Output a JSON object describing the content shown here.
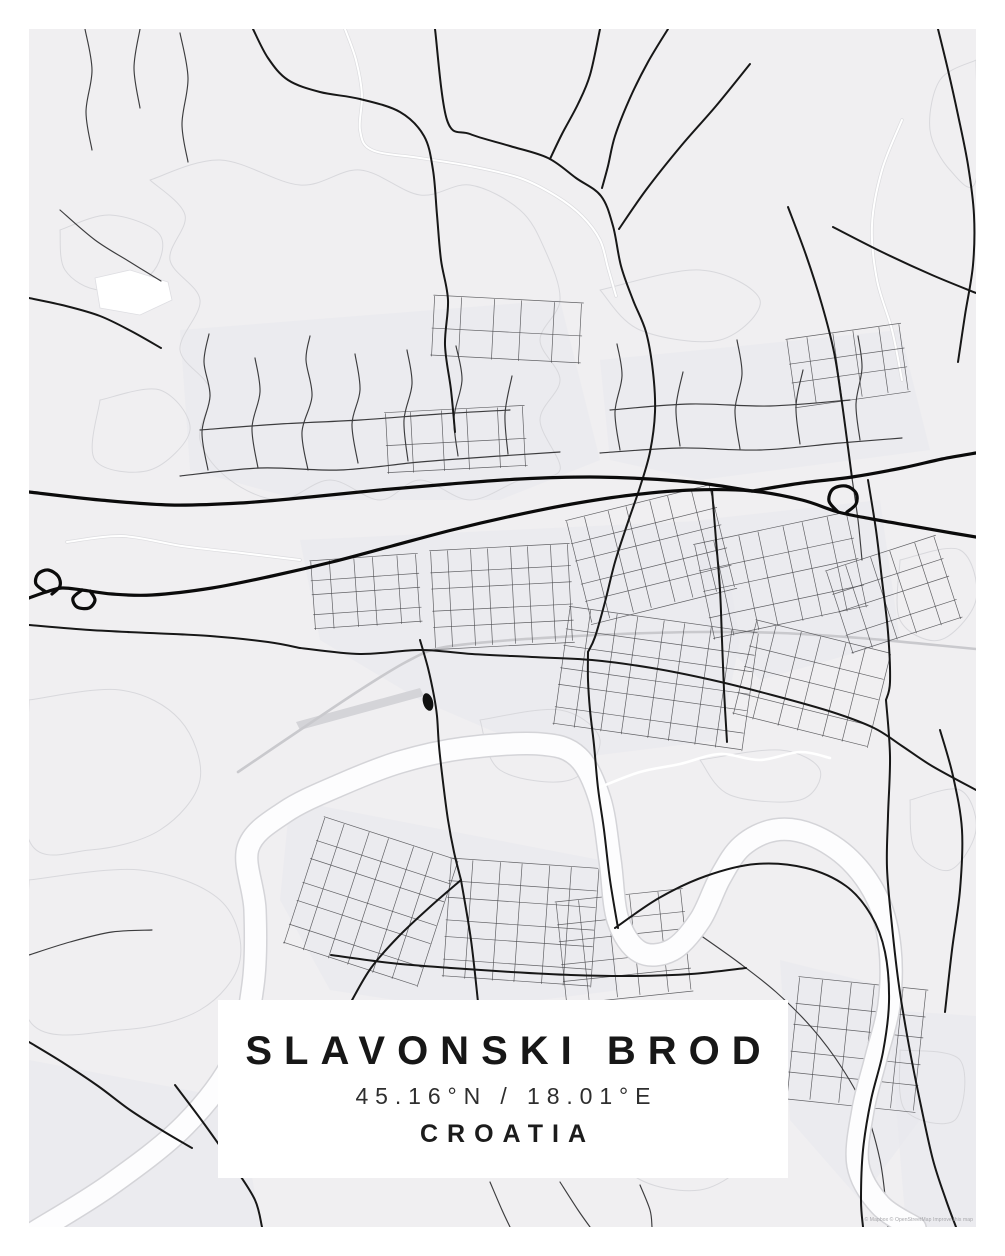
{
  "poster": {
    "title": "SLAVONSKI BROD",
    "coordinates": "45.16°N / 18.01°E",
    "country": "CROATIA",
    "attribution": "© Mapbox © OpenStreetMap Improve this map"
  },
  "colors": {
    "frame": "#ffffff",
    "map_background": "#f0eff1",
    "road_dark": "#171717",
    "river_white": "#fdfdfe",
    "built_tint": "#e9e9ee",
    "parcel_line": "#d8d8dc",
    "title_text": "#171717"
  },
  "map": {
    "frame_inset": 29,
    "rivers": [
      "35,1232 110,1185 185,1125 235,1058 253,985 255,910 248,848 285,812 340,785 400,762 465,748 540,744 578,757 600,800 610,860 618,920 640,952 672,950 700,920 720,878 742,846 775,830 812,835 850,860 878,900 890,948 889,1005 876,1058 863,1110 858,1165 880,1205 915,1228"
    ],
    "thin_water": [
      "598,788 640,772 680,764 720,754 760,760 800,752 830,758"
    ],
    "railway": [
      "238,772 300,730 360,690 406,662 440,648 500,641 560,637 620,634 700,632 780,633 860,638 935,645 976,649"
    ],
    "motorway": [
      "29,598 46,592 62,588 82,590 112,594 152,595 212,588 272,576 332,562 392,546 452,530 512,516 572,504 632,495 692,490 752,491 802,500 838,512 872,519 912,526 952,533 976,537",
      "29,492 100,500 170,505 240,503 310,497 380,490 450,484 520,479 590,477 650,479 700,483 752,491",
      "752,491 802,483 852,477 902,468 942,459 976,453",
      "46,592 36,584 38,574 48,570 58,576 60,586 52,594",
      "82,590 73,598 77,607 89,608 95,600 90,591",
      "838,512 829,501 833,489 846,486 856,493 856,504 847,512"
    ],
    "major_roads": [
      "253,29 268,58 288,80 320,92 360,99 400,112 424,136 433,170 437,215 441,260 448,300 445,345 451,390 455,432",
      "435,29 447,120 470,134 510,146 548,158 576,178 601,196 613,226 621,266 633,300 646,332 653,372 655,412 650,452 640,487 628,522 615,562 605,602 595,637 588,652",
      "600,29 590,75 578,104 562,134 550,159",
      "668,29 648,62 630,98 615,136 608,166 602,188",
      "750,64 716,106 681,146 646,190 619,229",
      "938,29 948,70 958,115 968,165 974,215 973,265 965,315 958,362",
      "833,227 882,252 932,275 976,293",
      "788,207 806,255 822,305 834,352 841,396 847,440 852,478",
      "300,648 360,654 420,650 472,654 532,657 592,660 652,668 712,680 772,695 832,712 874,728 902,746 932,766 976,790",
      "420,640 428,668 434,696 437,716 439,746 443,782 448,820 454,852 461,880",
      "461,880 431,906 399,936 371,968 351,1002",
      "461,880 471,940 478,1002",
      "331,955 391,963 451,968 511,972 571,975 631,976 691,974 746,968",
      "588,652 588,680 590,710 594,745 598,788 604,830 610,880 618,928",
      "615,928 659,898 706,876 756,864 806,868 846,886 871,915 885,952 889,1002 883,1052 871,1100 863,1150 861,1200 863,1227",
      "886,700 890,756 888,816 887,868 892,926 899,986 909,1046 921,1106 933,1160 946,1200 956,1227",
      "712,490 716,540 720,590 722,640 724,690 727,742",
      "868,480 876,530 882,580 888,632 890,682 886,700",
      "29,625 90,630 150,633 210,636 268,642 300,648",
      "29,298 66,306 100,316 131,331 161,348",
      "940,730 953,776 962,830 960,890 952,950 945,1012",
      "175,1085 205,1125 235,1168 255,1200 262,1227",
      "29,1042 62,1062 98,1086 130,1110 163,1131 192,1148"
    ],
    "medium_roads": [
      "180,476 260,468 340,470 420,462 500,456 560,452",
      "600,453 680,448 760,450 840,443 902,438",
      "208,470 202,432 210,396 204,362 209,334",
      "258,468 252,428 260,392 255,358",
      "308,470 302,432 312,396 306,360 310,336",
      "358,463 352,424 360,390 355,354",
      "408,461 404,420 412,384 407,350",
      "458,456 454,418 462,380 456,346",
      "508,454 505,414 512,376",
      "620,450 615,412 622,376 617,344",
      "680,446 676,408 683,372",
      "740,449 735,410 742,374 737,340",
      "800,444 796,406 803,370",
      "860,440 856,404 862,368 858,336",
      "200,430 280,424 360,420 440,414 510,410",
      "610,410 690,404 770,406 850,400",
      "85,29 92,70 86,112 92,150",
      "140,29 134,68 140,108",
      "180,33 188,78 182,124 188,162",
      "60,210 95,240 130,262 161,281",
      "700,935 738,962 776,992 812,1028 842,1068 866,1112 880,1160 886,1205 888,1227",
      "490,1182 502,1210 510,1227",
      "560,1182 578,1210 590,1227",
      "29,955 70,942 112,932 152,930",
      "640,1185 650,1210 652,1227",
      "852,478 858,520 862,560"
    ],
    "white_roads": [
      "345,29 356,60 362,95 360,130 372,150 420,158 470,166 520,178 556,196 582,216 600,240 608,268 616,296",
      "67,542 122,536 182,546 242,553 300,560",
      "902,120 882,170 872,225 877,280 892,330 902,380"
    ],
    "street_grids": [
      {
        "x": 432,
        "y": 548,
        "w": 140,
        "h": 96,
        "r": 5,
        "c": 7,
        "a": -3
      },
      {
        "x": 576,
        "y": 502,
        "w": 150,
        "h": 104,
        "r": 5,
        "c": 7,
        "a": -14
      },
      {
        "x": 702,
        "y": 528,
        "w": 158,
        "h": 96,
        "r": 4,
        "c": 7,
        "a": -12
      },
      {
        "x": 560,
        "y": 620,
        "w": 190,
        "h": 118,
        "r": 6,
        "c": 8,
        "a": 8
      },
      {
        "x": 742,
        "y": 636,
        "w": 138,
        "h": 96,
        "r": 4,
        "c": 6,
        "a": 14
      },
      {
        "x": 312,
        "y": 558,
        "w": 108,
        "h": 68,
        "r": 4,
        "c": 5,
        "a": -4
      },
      {
        "x": 300,
        "y": 836,
        "w": 140,
        "h": 132,
        "r": 6,
        "c": 6,
        "a": 18
      },
      {
        "x": 446,
        "y": 864,
        "w": 148,
        "h": 118,
        "r": 6,
        "c": 6,
        "a": 4
      },
      {
        "x": 560,
        "y": 896,
        "w": 128,
        "h": 100,
        "r": 5,
        "c": 5,
        "a": -6
      },
      {
        "x": 836,
        "y": 552,
        "w": 116,
        "h": 86,
        "r": 4,
        "c": 5,
        "a": -18
      },
      {
        "x": 790,
        "y": 332,
        "w": 116,
        "h": 66,
        "r": 3,
        "c": 5,
        "a": -8
      },
      {
        "x": 792,
        "y": 984,
        "w": 130,
        "h": 120,
        "r": 5,
        "c": 5,
        "a": 6
      },
      {
        "x": 432,
        "y": 300,
        "w": 150,
        "h": 60,
        "r": 2,
        "c": 5,
        "a": 3
      },
      {
        "x": 386,
        "y": 410,
        "w": 140,
        "h": 60,
        "r": 2,
        "c": 5,
        "a": -3
      }
    ],
    "built_patches": [
      "300,540 720,520 740,640 720,740 560,760 420,700 320,640",
      "290,800 600,860 620,990 460,1010 330,990 280,900",
      "700,520 880,500 900,640 760,680 700,620",
      "780,960 900,990 920,1120 860,1200 790,1120",
      "29,1060 240,1100 260,1227 29,1227",
      "180,330 560,300 600,460 500,500 300,500 190,470",
      "600,360 900,330 930,450 700,480 610,460",
      "888,1010 976,1016 976,1227 906,1227"
    ],
    "parcel_outlines": [
      "150,180 220,160 300,185 360,170 420,195 470,185 520,210 545,250 560,300 540,340 560,380 540,420 560,470 520,480 470,500 420,480 380,500 330,480 280,500 230,480 200,440 210,390 180,350 200,300 170,260 185,215",
      "60,230 110,215 160,235 150,275 100,290 65,270",
      "29,700 120,690 180,720 200,780 160,830 90,850 29,840",
      "29,880 140,870 220,900 240,960 200,1010 120,1030 29,1020",
      "900,560 960,550 976,600 940,640 900,620",
      "910,800 960,790 976,830 950,870 915,850",
      "700,760 780,750 820,770 800,800 730,795",
      "900,1050 960,1060 955,1120 905,1110",
      "976,60 940,80 930,130 950,170 976,180",
      "600,290 700,270 760,300 720,340 640,330",
      "100,400 160,390 190,430 150,470 95,460",
      "640,1040 740,1060 760,1140 700,1190 620,1160",
      "480,720 560,710 600,740 570,780 500,770",
      "340,1060 420,1070 440,1130 380,1160 330,1130"
    ],
    "white_blobs": [
      "95,278 130,270 168,282 172,300 140,315 100,308"
    ],
    "runways": [
      "296,722 420,688 424,696 300,730"
    ],
    "fortress": {
      "cx": 428,
      "cy": 702,
      "rx": 5,
      "ry": 9,
      "angle": -15
    }
  }
}
